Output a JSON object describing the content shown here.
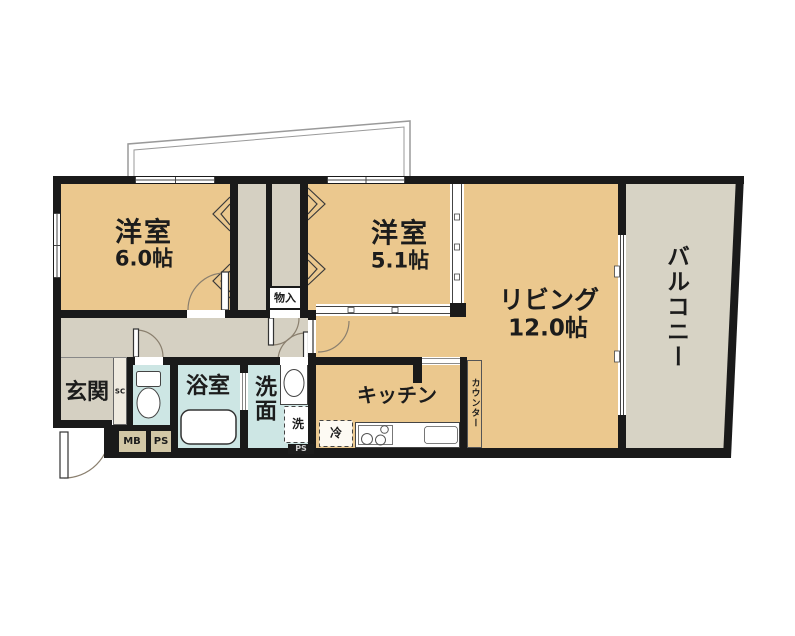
{
  "colors": {
    "wall": "#1a1a1a",
    "room_tan": "#ebc88e",
    "corridor_gray": "#d5d0c2",
    "balcony_gray": "#d7d3c5",
    "wet_blue": "#cde6e4",
    "utility_tan": "#d2c7a6"
  },
  "rooms": {
    "bedroom1": {
      "label": "洋室",
      "area": "6.0帖"
    },
    "bedroom2": {
      "label": "洋室",
      "area": "5.1帖"
    },
    "living": {
      "label": "リビング",
      "area": "12.0帖"
    },
    "balcony": {
      "label": "バルコニー"
    },
    "entrance": {
      "label": "玄関"
    },
    "bathroom": {
      "label": "浴室"
    },
    "washroom": {
      "label": "洗面"
    },
    "kitchen": {
      "label": "キッチン"
    },
    "storage": {
      "label": "物入"
    },
    "counter": {
      "label": "カウンター"
    }
  },
  "fixtures": {
    "washing_machine": "洗",
    "refrigerator": "冷",
    "shoe_cabinet": "SC",
    "meter_box": "MB",
    "pipe_shaft_1": "PS",
    "pipe_shaft_2": "PS"
  }
}
